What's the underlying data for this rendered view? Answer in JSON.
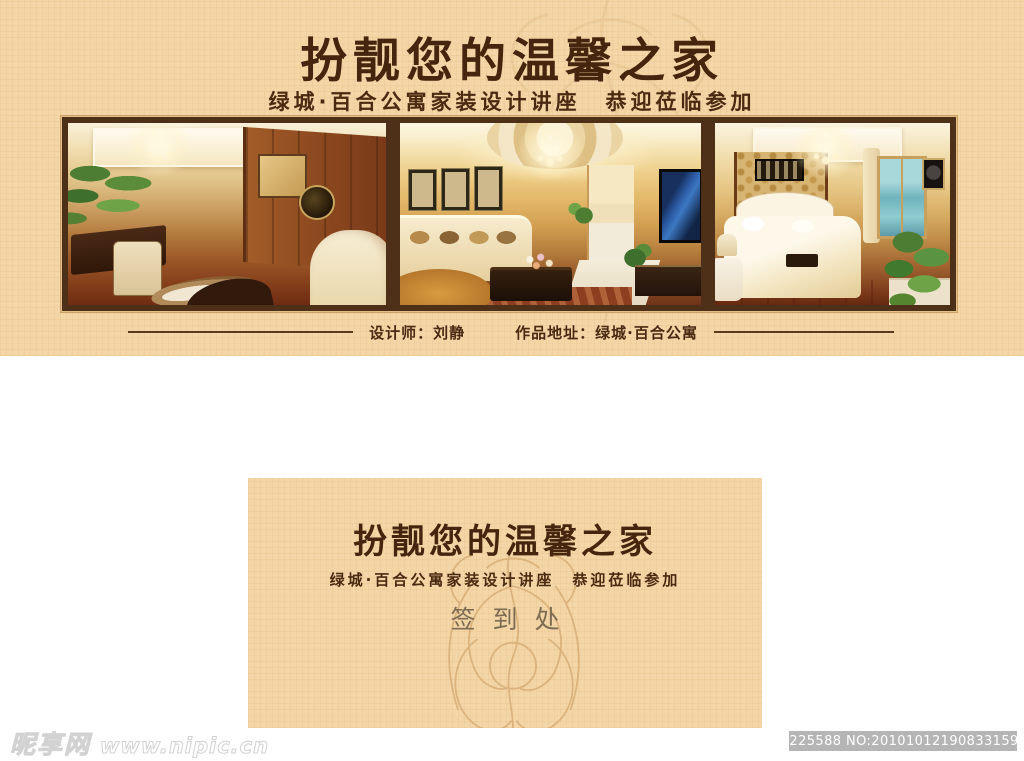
{
  "banner": {
    "title": "扮靓您的温馨之家",
    "subtitle": "绿城·百合公寓家装设计讲座　恭迎莅临参加",
    "credit": {
      "designer": "设计师：刘静",
      "location": "作品地址：绿城·百合公寓"
    }
  },
  "signin_card": {
    "title": "扮靓您的温馨之家",
    "subtitle": "绿城·百合公寓家装设计讲座　恭迎莅临参加",
    "label": "签到处"
  },
  "watermark": {
    "site": "昵享网",
    "url": "www.nipic.cn",
    "id_badge": "ID:2225588 NO:20101012190833159000"
  },
  "colors": {
    "banner_bg": "#f3d5a6",
    "title_brown": "#45250e",
    "frame_border": "#4e2f17",
    "flourish_tan": "#c9995c",
    "signin_label": "#7d6b52",
    "id_bar_bg": "#b5b5b5",
    "watermark_outline": "#d2d2d2",
    "page_bg": "#ffffff"
  }
}
